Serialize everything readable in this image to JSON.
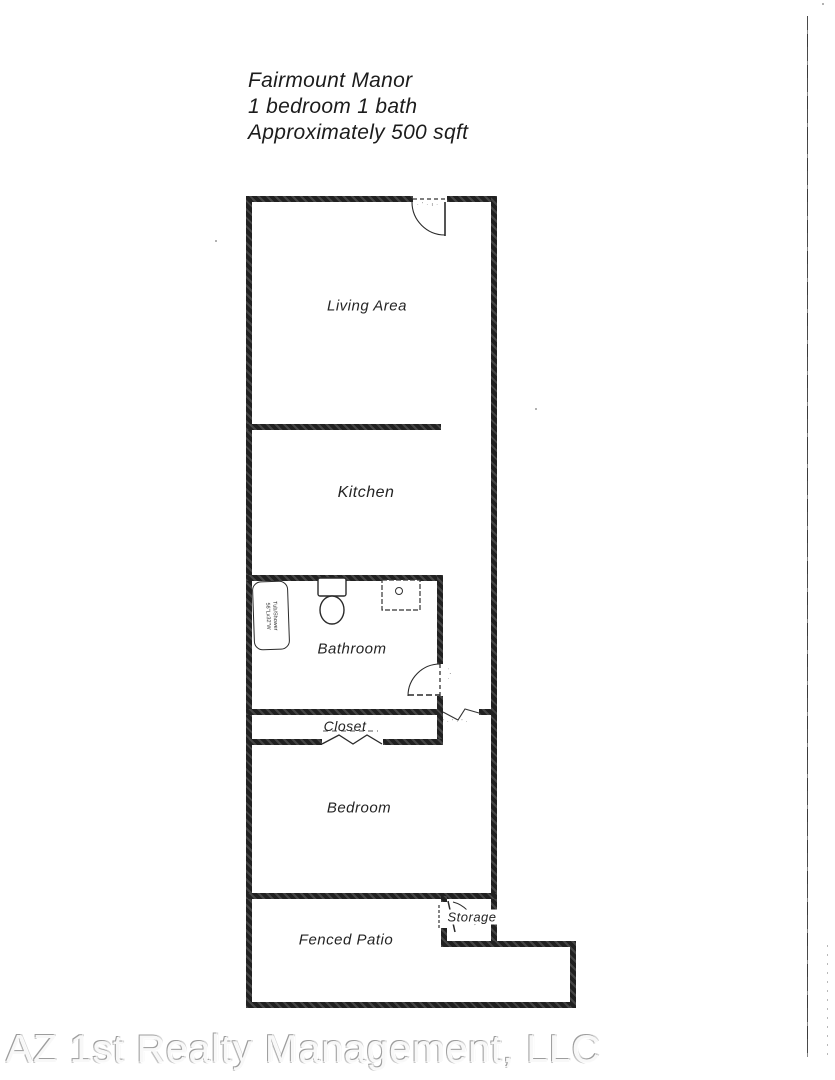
{
  "title": {
    "line1": "Fairmount Manor",
    "line2": "1 bedroom 1 bath",
    "line3": "Approximately 500 sqft"
  },
  "rooms": {
    "living_area": "Living Area",
    "kitchen": "Kitchen",
    "bathroom": "Bathroom",
    "closet": "Closet",
    "bedroom": "Bedroom",
    "fenced_patio": "Fenced Patio",
    "storage": "Storage"
  },
  "fixtures": {
    "tub": {
      "line1": "Tub/Shower",
      "line2": "56\"Lx32\"W"
    }
  },
  "annotations": {
    "entry_marks": "· ' · ı ·",
    "bath_door_marks": "· ' ·",
    "hall_opening_marks": "·' · ' · ' ·"
  },
  "footer": {
    "company": "AZ 1st Realty Management, LLC"
  },
  "colors": {
    "wall": "#212121",
    "line": "#2a2a2a",
    "label": "#242424"
  }
}
